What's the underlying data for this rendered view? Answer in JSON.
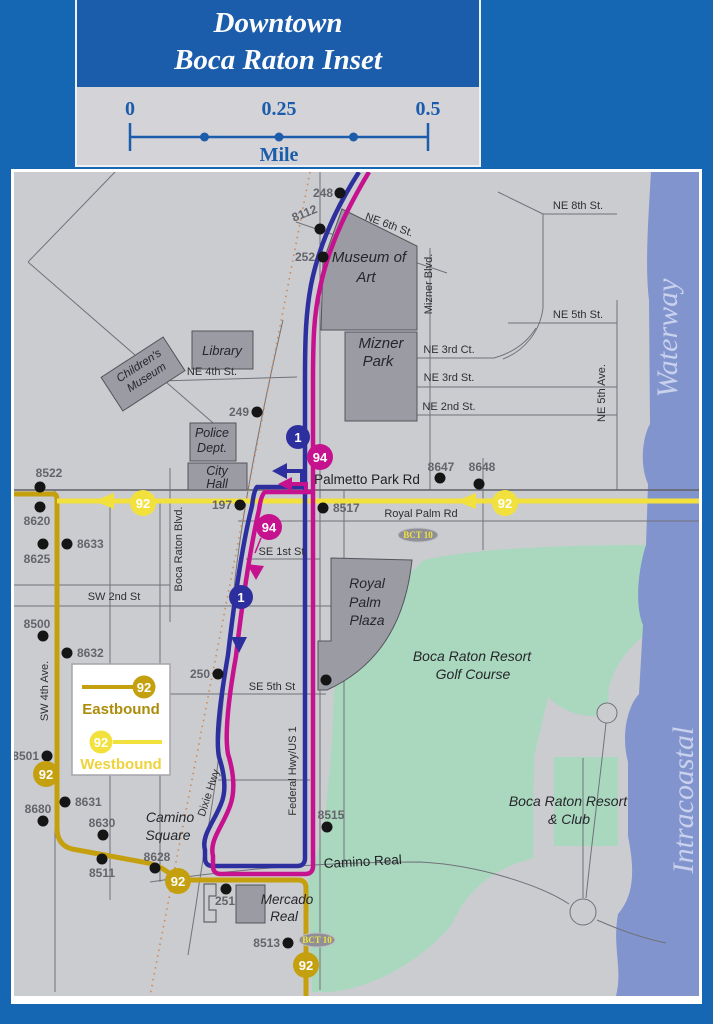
{
  "title": {
    "line1": "Downtown",
    "line2": "Boca Raton Inset"
  },
  "scale_bar": {
    "tick0": "0",
    "tick1": "0.25",
    "tick2": "0.5",
    "unit": "Mile"
  },
  "legend": {
    "route": "92",
    "eastbound_label": "Eastbound",
    "westbound_label": "Westbound"
  },
  "routes": {
    "route1": "1",
    "route94": "94",
    "route92": "92",
    "bct10": "BCT 10"
  },
  "water": {
    "upper": "Waterway",
    "lower": "Intracoastal"
  },
  "streets": [
    {
      "label": "NE 8th St."
    },
    {
      "label": "NE 6th St."
    },
    {
      "label": "NE 5th St."
    },
    {
      "label": "NE 3rd Ct."
    },
    {
      "label": "NE 3rd St."
    },
    {
      "label": "NE 2nd St."
    },
    {
      "label": "NE 4th St."
    },
    {
      "label": "NE 5th Ave."
    },
    {
      "label": "Mizner Blvd."
    },
    {
      "label": "Palmetto Park Rd"
    },
    {
      "label": "Royal Palm Rd"
    },
    {
      "label": "SE 1st St."
    },
    {
      "label": "SW 2nd St"
    },
    {
      "label": "SE 5th St"
    },
    {
      "label": "Boca Raton Blvd."
    },
    {
      "label": "Dixie Hwy"
    },
    {
      "label": "Federal Hwy/US 1"
    },
    {
      "label": "SW 4th Ave."
    },
    {
      "label": "Camino Real"
    }
  ],
  "places": [
    {
      "line1": "Museum of",
      "line2": "Art"
    },
    {
      "line1": "Mizner",
      "line2": "Park"
    },
    {
      "line1": "Library"
    },
    {
      "line1": "Children's",
      "line2": "Museum"
    },
    {
      "line1": "Police",
      "line2": "Dept."
    },
    {
      "line1": "City",
      "line2": "Hall"
    },
    {
      "line1": "Royal",
      "line2": "Palm",
      "line3": "Plaza"
    },
    {
      "line1": "Boca Raton Resort",
      "line2": "Golf Course"
    },
    {
      "line1": "Boca Raton Resort",
      "line2": "& Club"
    },
    {
      "line1": "Camino",
      "line2": "Square"
    },
    {
      "line1": "Mercado",
      "line2": "Real"
    }
  ],
  "stops": [
    {
      "id": "248"
    },
    {
      "id": "8112"
    },
    {
      "id": "252"
    },
    {
      "id": "249"
    },
    {
      "id": "8522"
    },
    {
      "id": "8620"
    },
    {
      "id": "8625"
    },
    {
      "id": "8633"
    },
    {
      "id": "197"
    },
    {
      "id": "8517"
    },
    {
      "id": "8647"
    },
    {
      "id": "8648"
    },
    {
      "id": "8500"
    },
    {
      "id": "8632"
    },
    {
      "id": "250"
    },
    {
      "id": "8501"
    },
    {
      "id": "8680"
    },
    {
      "id": "8631"
    },
    {
      "id": "8630"
    },
    {
      "id": "8511"
    },
    {
      "id": "8628"
    },
    {
      "id": "8515"
    },
    {
      "id": "251"
    },
    {
      "id": "8513"
    }
  ],
  "colors": {
    "frame_blue": "#1566b3",
    "title_blue": "#1b5cab",
    "map_background": "#cbccd0",
    "route_1_blue": "#2e2f9e",
    "route_94_magenta": "#c6128f",
    "route_92_eastbound_gold": "#c5a00e",
    "route_92_westbound_yellow": "#f2e13c",
    "water_blue": "#8294ce",
    "golf_green": "#a9d8bf",
    "building_gray": "#9a9ba3",
    "railroad_orange": "#cf8a52"
  }
}
